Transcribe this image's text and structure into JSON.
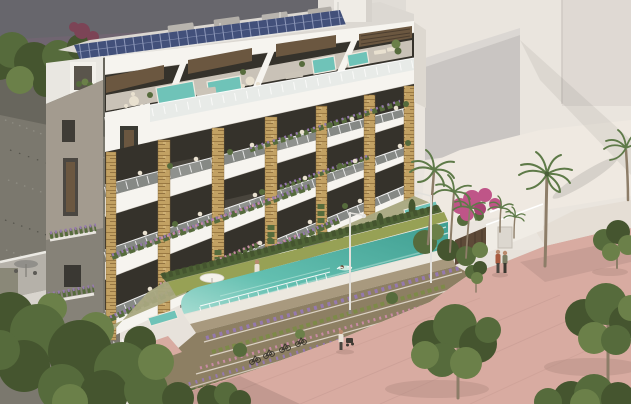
{
  "scene": {
    "description": "Aerial 3D architectural rendering of a modern white apartment building with rooftop solar panels and hot-tub terraces, golden stone-clad balcony piers with cascading flower planters, a turquoise lap pool with a swimmer, terraced flower gardens with parked bicycles, palm trees, street trees and a pink pedestrian promenade with walkers; gray neighbouring building at top-left, pale sunlit buildings to the right, gravel lot and dense green trees at lower-left.",
    "elements": [
      "apartment-building",
      "solar-panel-array",
      "roof-vents",
      "roof-elevator-box",
      "penthouse-terraces",
      "hot-tubs",
      "penthouse-furniture",
      "glass-railings",
      "stone-clad-piers",
      "balcony-planters",
      "side-tower",
      "side-wall-windows",
      "hanging-planters",
      "corner-window",
      "privacy-hedge",
      "lawn-strip",
      "parasol",
      "sun-loungers",
      "plunge-pools",
      "lap-pool",
      "swimmer",
      "pool-glass-fence",
      "terraced-flower-gardens",
      "bicycles",
      "pink-promenade",
      "garden-ramp",
      "street-lamps",
      "pedestrian-couple",
      "person-with-stroller",
      "person-on-lawn",
      "palm-trees",
      "street-trees",
      "boundary-wood-fence",
      "boundary-white-wall",
      "gate",
      "bougainvillea",
      "background-building-dark",
      "background-building-white",
      "background-cube",
      "gravel-lot",
      "left-terrace-parasol"
    ]
  },
  "colors": {
    "backdrop": "#e7e2db",
    "bldg-dark": "#67666c",
    "purple-band": "#7c6377",
    "bldg-white-bg": "#e0dcd6",
    "wall-light": "#eae5de",
    "wall-shade": "#d9d3cd",
    "cube-face": "#c9c5c2",
    "cube-top": "#dbd7d3",
    "ground-sunlit": "#efe9e1",
    "gravel": "#7b786e",
    "gravel-dark": "#646259",
    "white": "#f6f4ef",
    "slab-shadow": "#c9c4bc",
    "stone": "#c2a163",
    "stone-streak": "#96743f",
    "window-dark": "#35322b",
    "wood": "#6b5740",
    "wood-dark": "#4c3e2f",
    "terrace-floor": "#d9d2c6",
    "glass": "#d8e0df",
    "solar": "#42507a",
    "solar-grid": "#8d97b8",
    "hedge": "#4f6336",
    "lawn": "#97a155",
    "patio": "#a9a87f",
    "pool-light": "#a5dcd1",
    "pool": "#63bfb0",
    "pool-deep": "#3f9e91",
    "coping": "#ece8df",
    "retain": "#a8997e",
    "soil": "#8d7f63",
    "promenade": "#d8aba1",
    "prom-shadow": "#b08a80",
    "flower-purple": "#9579ad",
    "flower-pink": "#c88ba4",
    "flower-olive": "#7d8a48",
    "tub": "#6fc3b8",
    "foliage-dark": "#45552f",
    "foliage-mid": "#566b3c",
    "foliage-light": "#6b8049",
    "palm": "#5e7a48",
    "trunk": "#8d7d68",
    "fence-wood": "#5e4a38",
    "bougainvillea": "#bf5588",
    "lamp": "#e3e1dc",
    "skin": "#b98a6e",
    "shirt-red": "#a85a3e",
    "shirt-light": "#e9e2d6",
    "pants-dark": "#4a463f",
    "cream": "#e9e1d0",
    "sofa": "#cbc4b8",
    "shrub-maroon": "#7c4456",
    "tower": "#a39b8f",
    "moss-wall": "#8a8878"
  }
}
